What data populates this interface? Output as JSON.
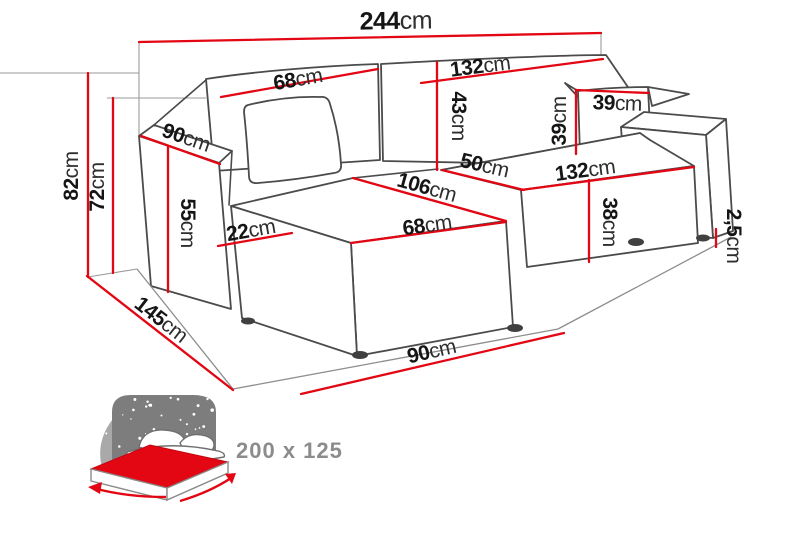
{
  "diagram": {
    "type": "furniture-dimension-diagram",
    "dims": [
      {
        "id": "total-width",
        "num": "244",
        "unit": "cm"
      },
      {
        "id": "back-left-width",
        "num": "68",
        "unit": "cm"
      },
      {
        "id": "back-right-width",
        "num": "132",
        "unit": "cm"
      },
      {
        "id": "back-height",
        "num": "43",
        "unit": "cm"
      },
      {
        "id": "pillow-width",
        "num": "39",
        "unit": "cm"
      },
      {
        "id": "pillow-height",
        "num": "39",
        "unit": "cm"
      },
      {
        "id": "armrest-depth",
        "num": "90",
        "unit": "cm"
      },
      {
        "id": "seat-depth",
        "num": "50",
        "unit": "cm"
      },
      {
        "id": "seat-front-width",
        "num": "132",
        "unit": "cm"
      },
      {
        "id": "chaise-length",
        "num": "106",
        "unit": "cm"
      },
      {
        "id": "chaise-front-width",
        "num": "68",
        "unit": "cm"
      },
      {
        "id": "seat-height",
        "num": "38",
        "unit": "cm"
      },
      {
        "id": "armrest-height",
        "num": "55",
        "unit": "cm"
      },
      {
        "id": "armrest-above-seat",
        "num": "22",
        "unit": "cm"
      },
      {
        "id": "total-height",
        "num": "82",
        "unit": "cm"
      },
      {
        "id": "back-top-height",
        "num": "72",
        "unit": "cm"
      },
      {
        "id": "chaise-total-depth",
        "num": "145",
        "unit": "cm"
      },
      {
        "id": "front-section-width",
        "num": "90",
        "unit": "cm"
      },
      {
        "id": "leg-height",
        "num": "2,5",
        "unit": "cm"
      }
    ],
    "sleeping_area": {
      "label": "200 x 125"
    },
    "colors": {
      "dimension_red": "#e30613",
      "outline_gray": "#4b4b4b",
      "icon_dark_gray": "#7d7d7d",
      "icon_light_gray": "#a9a9a9",
      "label_gray": "#8c8c8c"
    }
  }
}
